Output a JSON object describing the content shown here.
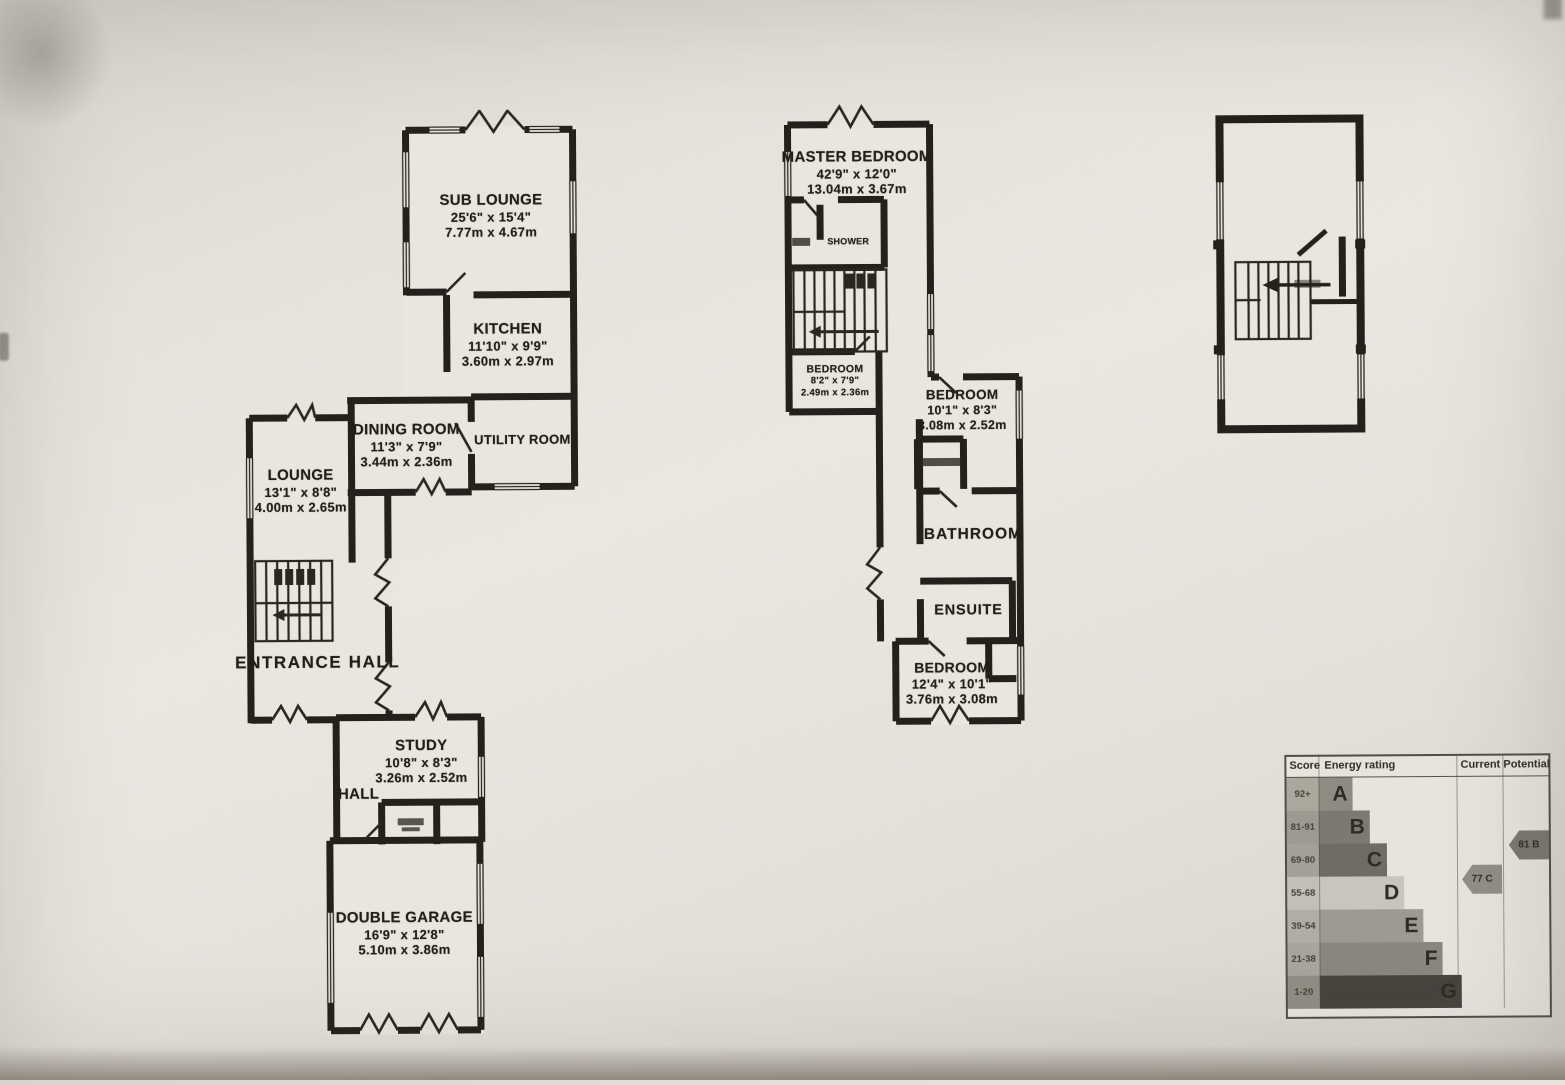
{
  "plans": {
    "ground_floor": {
      "rooms": [
        {
          "name": "SUB LOUNGE",
          "imperial": "25'6\" x 15'4\"",
          "metric": "7.77m x 4.67m"
        },
        {
          "name": "KITCHEN",
          "imperial": "11'10\" x 9'9\"",
          "metric": "3.60m x 2.97m"
        },
        {
          "name": "DINING ROOM",
          "imperial": "11'3\" x 7'9\"",
          "metric": "3.44m x 2.36m"
        },
        {
          "name": "UTILITY ROOM",
          "imperial": "",
          "metric": ""
        },
        {
          "name": "LOUNGE",
          "imperial": "13'1\" x 8'8\"",
          "metric": "4.00m x 2.65m"
        },
        {
          "name": "ENTRANCE HALL",
          "imperial": "",
          "metric": ""
        },
        {
          "name": "STUDY",
          "imperial": "10'8\" x 8'3\"",
          "metric": "3.26m x 2.52m"
        },
        {
          "name": "HALL",
          "imperial": "",
          "metric": ""
        },
        {
          "name": "DOUBLE GARAGE",
          "imperial": "16'9\" x 12'8\"",
          "metric": "5.10m x 3.86m"
        }
      ]
    },
    "first_floor": {
      "rooms": [
        {
          "name": "MASTER BEDROOM",
          "imperial": "42'9\" x 12'0\"",
          "metric": "13.04m x 3.67m"
        },
        {
          "name": "SHOWER",
          "imperial": "",
          "metric": ""
        },
        {
          "name": "BEDROOM",
          "imperial": "8'2\" x 7'9\"",
          "metric": "2.49m x 2.36m"
        },
        {
          "name": "BEDROOM",
          "imperial": "10'1\" x 8'3\"",
          "metric": "3.08m x 2.52m"
        },
        {
          "name": "BATHROOM",
          "imperial": "",
          "metric": ""
        },
        {
          "name": "ENSUITE",
          "imperial": "",
          "metric": ""
        },
        {
          "name": "BEDROOM",
          "imperial": "12'4\" x 10'1\"",
          "metric": "3.76m x 3.08m"
        }
      ]
    },
    "second_floor": {
      "rooms": []
    }
  },
  "epc": {
    "headers": [
      "Score",
      "Energy rating",
      "Current",
      "Potential"
    ],
    "bands": [
      {
        "score": "92+",
        "letter": "A",
        "width": 34,
        "color": "#8e8b82",
        "score_bg": "#aaa79d"
      },
      {
        "score": "81-91",
        "letter": "B",
        "width": 51,
        "color": "#7c7970",
        "score_bg": "#9d9a91"
      },
      {
        "score": "69-80",
        "letter": "C",
        "width": 68,
        "color": "#6f6c63",
        "score_bg": "#a3a097"
      },
      {
        "score": "55-68",
        "letter": "D",
        "width": 85,
        "color": "#c8c5bd",
        "score_bg": "#c2bfb7"
      },
      {
        "score": "39-54",
        "letter": "E",
        "width": 104,
        "color": "#9d9a91",
        "score_bg": "#b0ada4"
      },
      {
        "score": "21-38",
        "letter": "F",
        "width": 123,
        "color": "#8a877e",
        "score_bg": "#a8a59c"
      },
      {
        "score": "1-20",
        "letter": "G",
        "width": 142,
        "color": "#47443e",
        "score_bg": "#908d84"
      }
    ],
    "current": {
      "label": "77 C",
      "value": 77,
      "letter": "C",
      "color": "#918e85"
    },
    "potential": {
      "label": "81 B",
      "value": 81,
      "letter": "B",
      "color": "#7b786f"
    }
  }
}
